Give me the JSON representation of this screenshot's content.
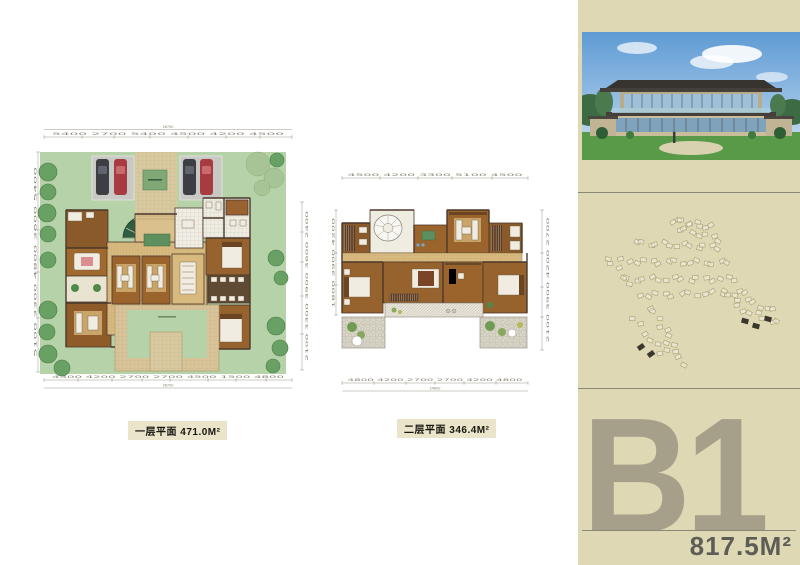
{
  "captions": {
    "plan1": "一层平面 471.0M²",
    "plan2": "二层平面 346.4M²"
  },
  "sidebar": {
    "unit": "B1",
    "area": "817.5M²"
  },
  "plan1": {
    "dims": {
      "top_total": "26700",
      "top": "5400 2700 5400 4500 4200 4500",
      "bottom": "4500 4200 2700 2700 4500 1500 4800",
      "bottom_total": "26700",
      "left": "5100 3300 4800 3600 5400",
      "right": "2100 3300 3900 3600 2400"
    }
  },
  "plan2": {
    "dims": {
      "top": "4500 4200 3300 5100 4500",
      "bottom": "4800 4200 2700 2700 4200 4800",
      "bottom_total": "24600",
      "left": "1800 3900 4200",
      "right": "2100 3900 4200 2700"
    }
  },
  "colors": {
    "sidebar_bg": "#ded8b4",
    "unit_text": "#a6a08a",
    "area_text": "#5d5d55",
    "divider": "#8a8876",
    "lawn": "#b6d2a9",
    "courtyard_tan": "#d8ba7f",
    "caption_bg": "#eae4cb",
    "wall": "#4b382b",
    "tree": "#69a063",
    "site_outline": "#a89f72"
  }
}
